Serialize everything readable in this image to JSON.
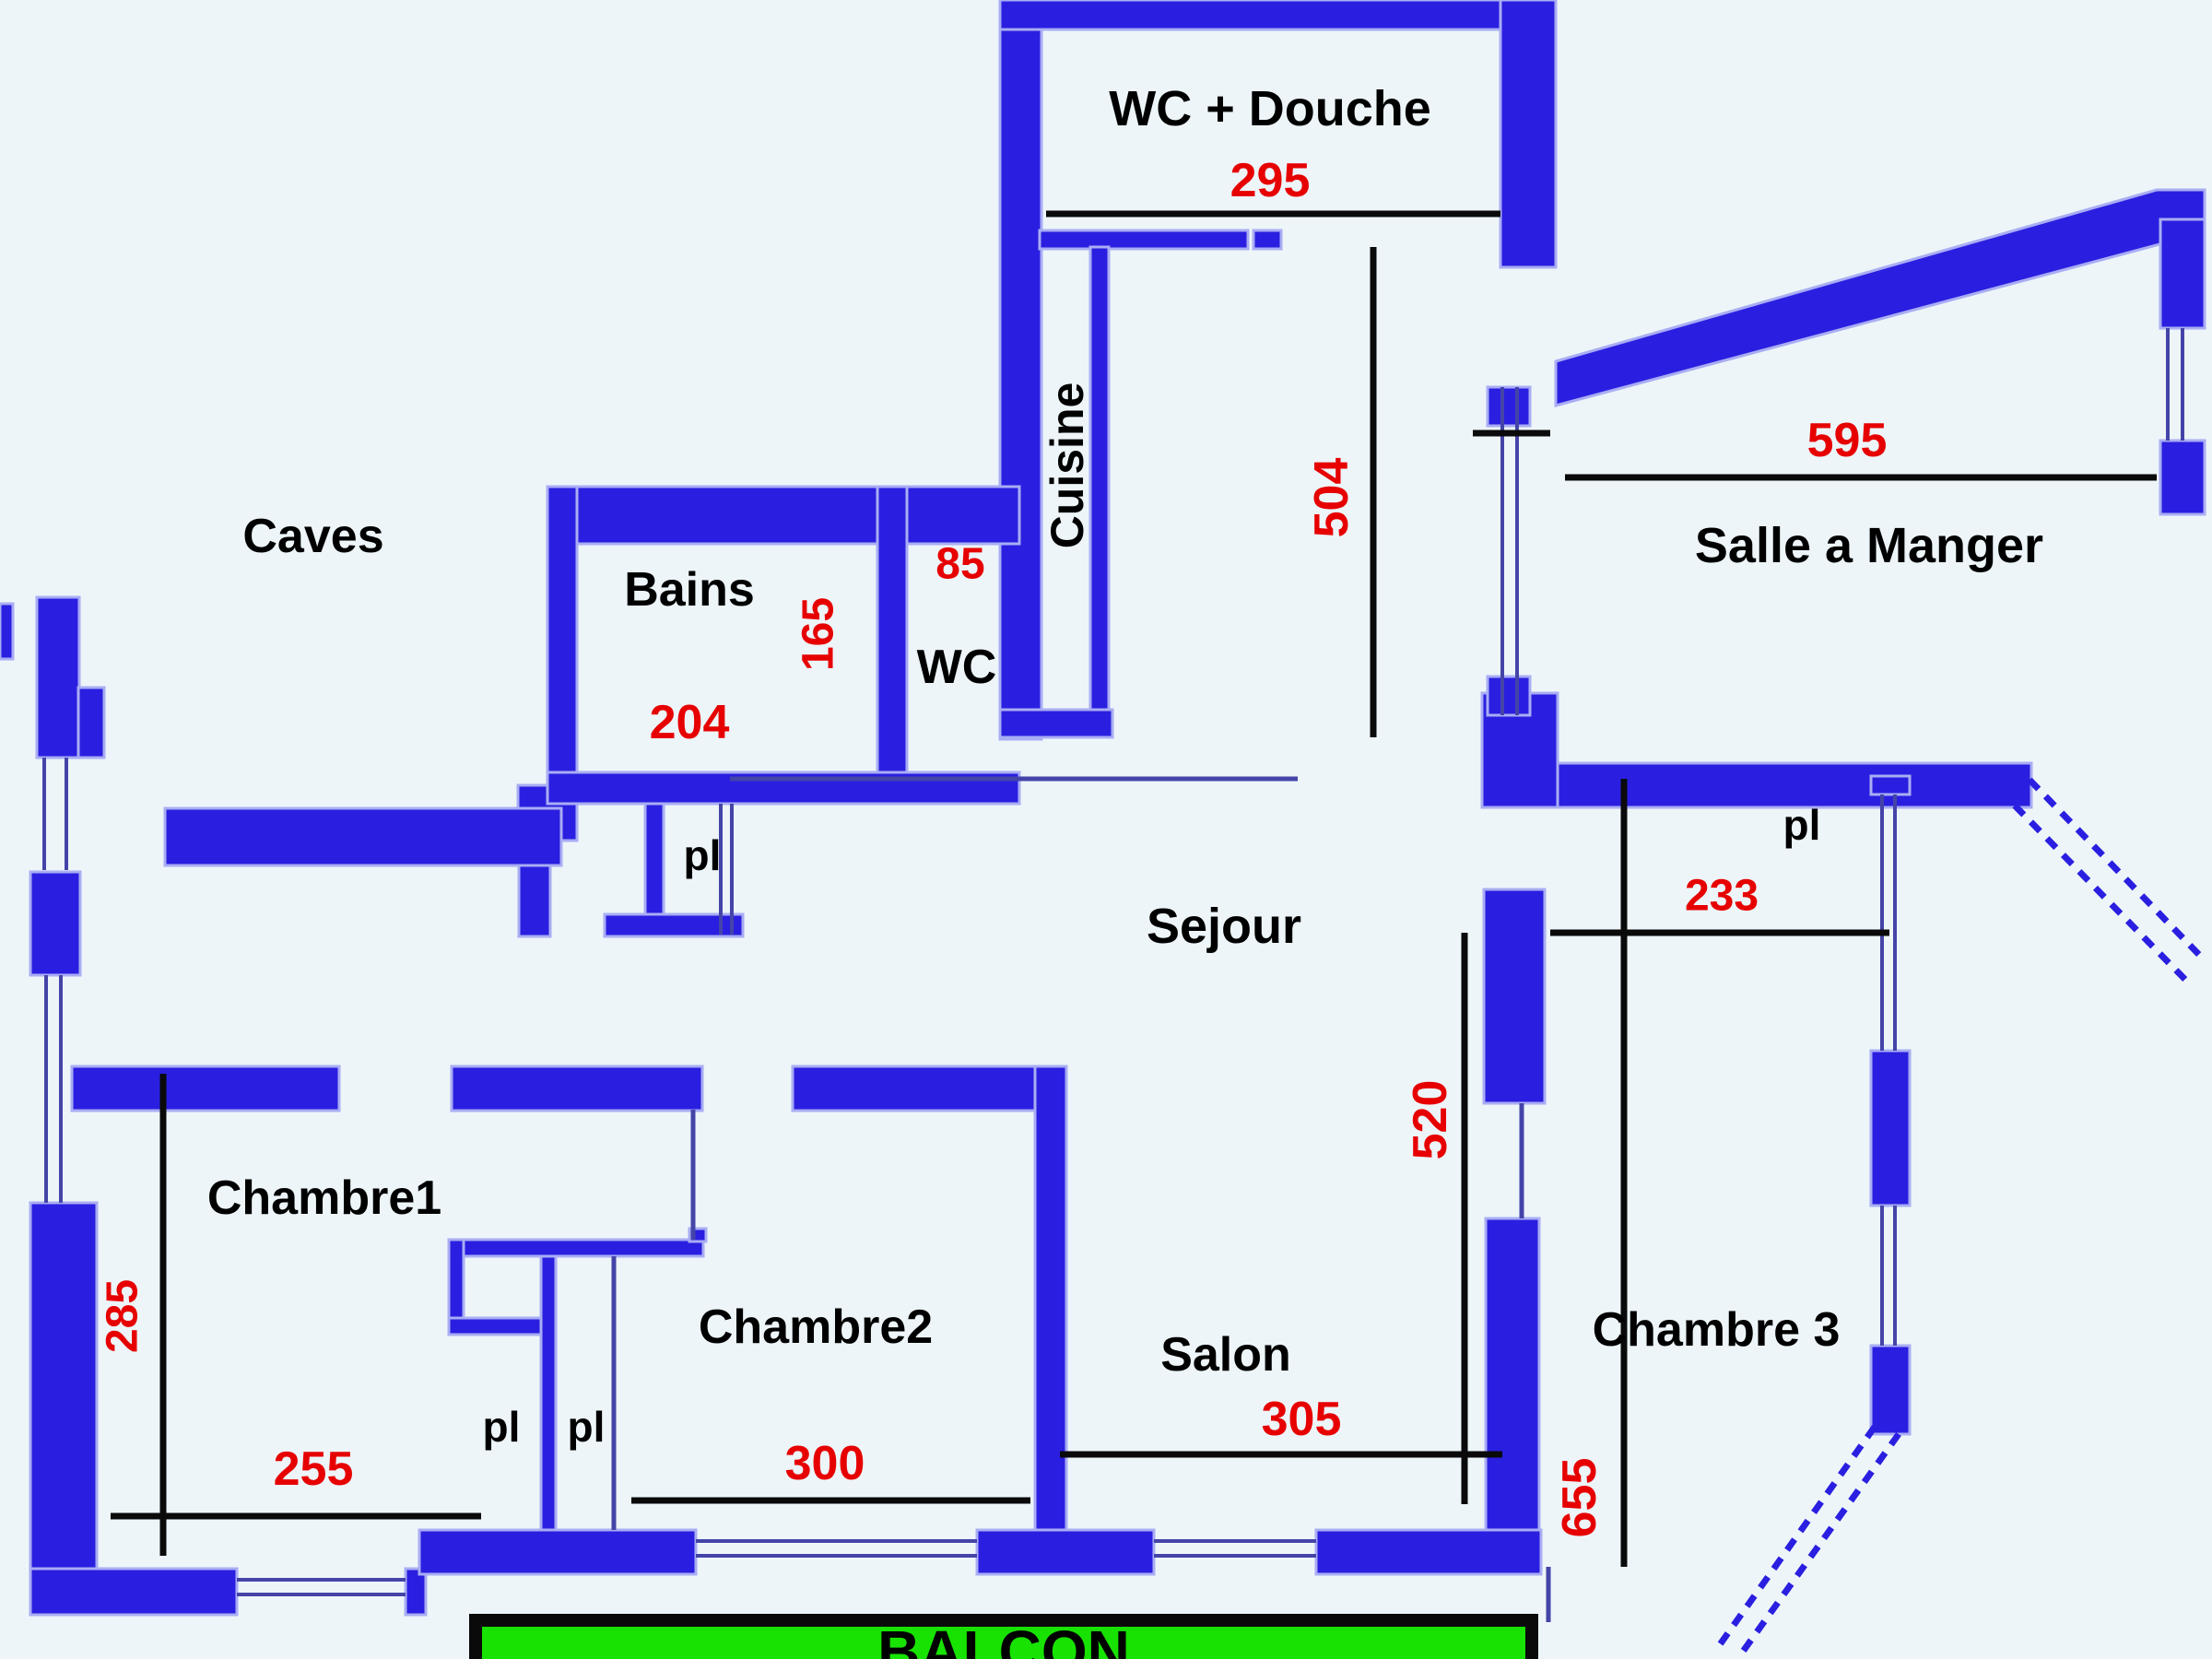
{
  "plan": {
    "colors": {
      "background": "#edf5f9",
      "wall": "#2a1fe0",
      "wall_edge": "#a9adf4",
      "dimension_text": "#e60000",
      "label_text": "#000000",
      "balcony_fill": "#17e202",
      "dimension_line": "#0a0a0a"
    },
    "rooms": [
      {
        "label": "Caves"
      },
      {
        "label": "WC + Douche"
      },
      {
        "label": "Cuisine"
      },
      {
        "label": "Bains"
      },
      {
        "label": "WC"
      },
      {
        "label": "Sejour"
      },
      {
        "label": "Salle a Manger"
      },
      {
        "label": "Chambre1"
      },
      {
        "label": "Chambre2"
      },
      {
        "label": "Salon"
      },
      {
        "label": "Chambre 3"
      },
      {
        "label": "BALCON"
      }
    ],
    "closets": [
      {
        "label": "pl"
      },
      {
        "label": "pl"
      },
      {
        "label": "pl"
      },
      {
        "label": "pl"
      }
    ],
    "dimensions_cm": [
      {
        "value": "295"
      },
      {
        "value": "504"
      },
      {
        "value": "595"
      },
      {
        "value": "204"
      },
      {
        "value": "165"
      },
      {
        "value": "85"
      },
      {
        "value": "233"
      },
      {
        "value": "520"
      },
      {
        "value": "285"
      },
      {
        "value": "255"
      },
      {
        "value": "300"
      },
      {
        "value": "305"
      },
      {
        "value": "655"
      }
    ]
  }
}
